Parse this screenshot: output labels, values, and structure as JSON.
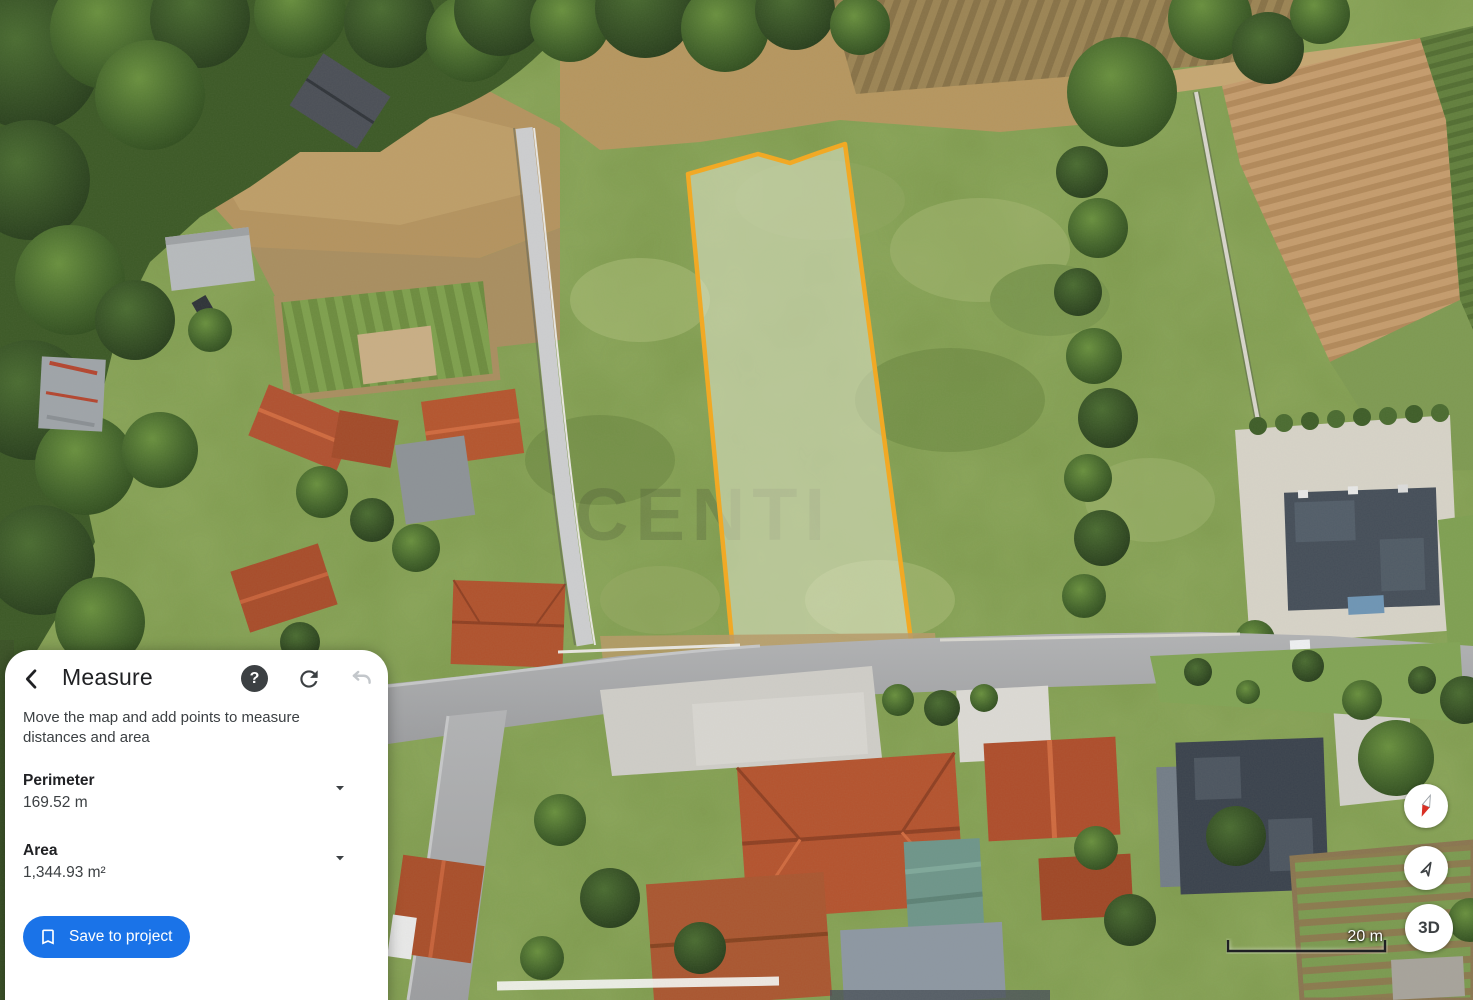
{
  "colors": {
    "accent_blue": "#1a73e8",
    "measure_outline": "#F4A920",
    "panel_background": "#ffffff",
    "text_primary": "#202124",
    "text_secondary": "#3c4043",
    "disabled_icon": "#c3c7cb"
  },
  "panel": {
    "title": "Measure",
    "help_glyph": "?",
    "description": "Move the map and add points to measure distances and area",
    "metrics": [
      {
        "label": "Perimeter",
        "value": "169.52 m"
      },
      {
        "label": "Area",
        "value": "1,344.93 m²"
      }
    ],
    "save_button_label": "Save to project"
  },
  "map": {
    "watermark": "CENTI",
    "scale_label": "20 m",
    "view_3d_label": "3D"
  }
}
